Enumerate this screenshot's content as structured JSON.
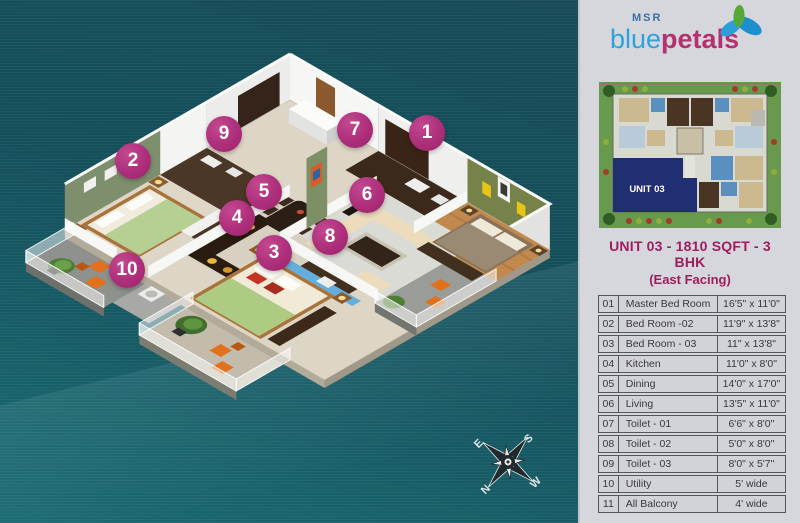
{
  "logo": {
    "msr": "MSR",
    "blue": "blue",
    "petals": "petals"
  },
  "site_plan": {
    "unit_label": "UNIT 03"
  },
  "unit_info": {
    "title": "UNIT 03 - 1810 SQFT - 3 BHK",
    "subtitle": "(East Facing)"
  },
  "room_table": {
    "rows": [
      {
        "no": "01",
        "name": "Master Bed Room",
        "size": "16'5\" x 11'0\""
      },
      {
        "no": "02",
        "name": "Bed Room -02",
        "size": "11'9\" x 13'8\""
      },
      {
        "no": "03",
        "name": "Bed Room - 03",
        "size": "11\" x 13'8\""
      },
      {
        "no": "04",
        "name": "Kitchen",
        "size": "11'0\" x 8'0\""
      },
      {
        "no": "05",
        "name": "Dining",
        "size": "14'0\" x 17'0\""
      },
      {
        "no": "06",
        "name": "Living",
        "size": "13'5\" x 11'0\""
      },
      {
        "no": "07",
        "name": "Toilet - 01",
        "size": "6'6\" x 8'0\""
      },
      {
        "no": "08",
        "name": "Toilet - 02",
        "size": "5'0\" x 8'0\""
      },
      {
        "no": "09",
        "name": "Toilet - 03",
        "size": "8'0\" x 5'7\""
      },
      {
        "no": "10",
        "name": "Utility",
        "size": "5' wide"
      },
      {
        "no": "11",
        "name": "All Balcony",
        "size": "4' wide"
      }
    ]
  },
  "floor_markers": [
    {
      "n": "1",
      "x": 427,
      "y": 133
    },
    {
      "n": "2",
      "x": 133,
      "y": 161
    },
    {
      "n": "3",
      "x": 274,
      "y": 253
    },
    {
      "n": "4",
      "x": 237,
      "y": 218
    },
    {
      "n": "5",
      "x": 264,
      "y": 192
    },
    {
      "n": "6",
      "x": 367,
      "y": 195
    },
    {
      "n": "7",
      "x": 355,
      "y": 130
    },
    {
      "n": "8",
      "x": 330,
      "y": 237
    },
    {
      "n": "9",
      "x": 224,
      "y": 134
    },
    {
      "n": "10",
      "x": 127,
      "y": 270
    }
  ],
  "compass": {
    "north": "N",
    "south": "S",
    "east": "E",
    "west": "W"
  },
  "colors": {
    "teal_bg": "#15505c",
    "panel_bg": "#d6d7dc",
    "accent_magenta": "#9e1d5f",
    "marker": "#ad2e7b",
    "olive_wall": "#7e8f6e",
    "unit_navy": "#202f72",
    "logo_blue": "#2da2dc",
    "logo_pink": "#b5306e"
  }
}
